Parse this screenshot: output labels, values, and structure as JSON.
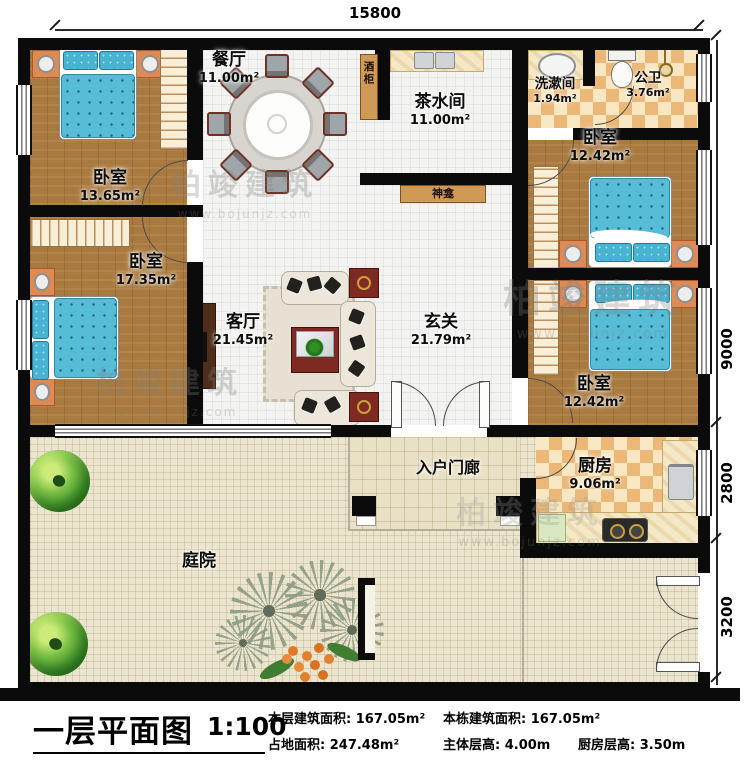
{
  "dimensions": {
    "top": "15800",
    "right": [
      "9000",
      "2800",
      "3200"
    ]
  },
  "rooms": {
    "bed1": {
      "name": "卧室",
      "area": "13.65m²"
    },
    "bed2": {
      "name": "卧室",
      "area": "17.35m²"
    },
    "bed3": {
      "name": "卧室",
      "area": "12.42m²"
    },
    "bed4": {
      "name": "卧室",
      "area": "12.42m²"
    },
    "dining": {
      "name": "餐厅",
      "area": "11.00m²"
    },
    "tea": {
      "name": "茶水间",
      "area": "11.00m²"
    },
    "wash": {
      "name": "洗漱间",
      "area": "1.94m²"
    },
    "bath": {
      "name": "公卫",
      "area": "3.76m²"
    },
    "living": {
      "name": "客厅",
      "area": "21.45m²"
    },
    "foyer": {
      "name": "玄关",
      "area": "21.79m²"
    },
    "kitchen": {
      "name": "厨房",
      "area": "9.06m²"
    },
    "porch": {
      "name": "入户门廊"
    },
    "courtyard": {
      "name": "庭院"
    },
    "wine_cabinet": {
      "name": "酒柜"
    },
    "shrine": {
      "name": "神龛"
    }
  },
  "titleblock": {
    "title": "一层平面图",
    "scale": "1:100",
    "stats": [
      {
        "label": "本层建筑面积:",
        "value": "167.05m²"
      },
      {
        "label": "本栋建筑面积:",
        "value": "167.05m²"
      },
      {
        "label": "占地面积:",
        "value": "247.48m²"
      },
      {
        "label": "主体层高:",
        "value": "4.00m"
      },
      {
        "label": "厨房层高:",
        "value": "3.50m"
      }
    ]
  },
  "watermark": {
    "brand": "柏竣建筑",
    "url": "www.bojunjz.com"
  }
}
